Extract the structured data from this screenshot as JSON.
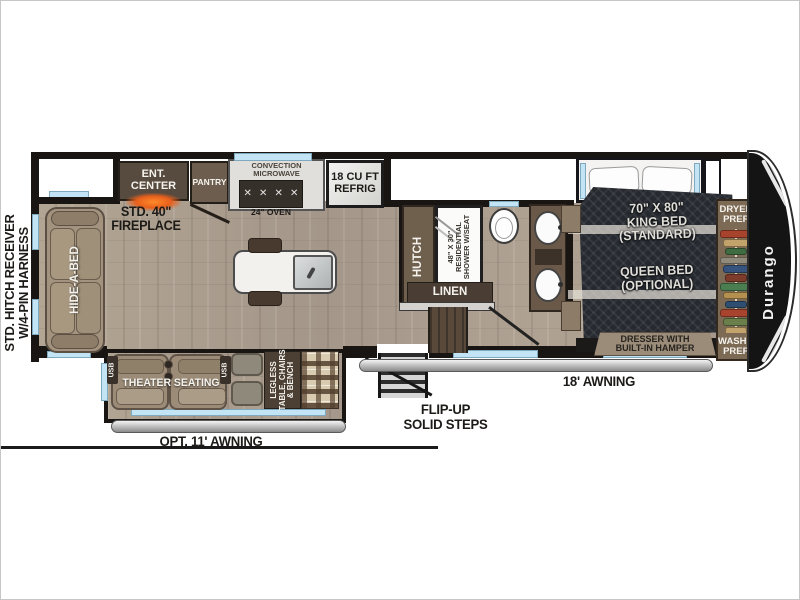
{
  "hitch": {
    "line1": "STD. HITCH RECEIVER",
    "line2": "W/4-PIN HARNESS"
  },
  "kitchen": {
    "ent_center": [
      "ENT.",
      "CENTER"
    ],
    "fireplace": [
      "STD. 40\"",
      "FIREPLACE"
    ],
    "pantry": "PANTRY",
    "microwave": [
      "CONVECTION",
      "MICROWAVE"
    ],
    "oven": "24\" OVEN",
    "refrig": [
      "18 CU FT",
      "REFRIG"
    ]
  },
  "living": {
    "hide_a_bed": "HIDE-A-BED",
    "theater": "THEATER SEATING",
    "usb_left": "USB",
    "usb_right": "USB",
    "dinette": [
      "LEGLESS",
      "TABLE, CHAIRS",
      "& BENCH"
    ],
    "hutch": "HUTCH"
  },
  "bath": {
    "shower": [
      "48\" X 30\"",
      "RESIDENTIAL",
      "SHOWER W/SEAT"
    ],
    "linen": "LINEN"
  },
  "bedroom": {
    "bed": [
      "70\" X 80\"",
      "KING BED",
      "(STANDARD)",
      "QUEEN BED",
      "(OPTIONAL)"
    ],
    "dresser": [
      "DRESSER WITH",
      "BUILT-IN HAMPER"
    ],
    "dryer": [
      "DRYER",
      "PREP"
    ],
    "washer": [
      "WASHER",
      "PREP"
    ],
    "closet_colors": [
      "#a8432d",
      "#c2a36b",
      "#3f6b41",
      "#8f8a7c",
      "#35537c",
      "#7d3b2b",
      "#4a7d50",
      "#b3904f",
      "#2f4f72",
      "#a8432d",
      "#6b7f4a",
      "#c2a36b",
      "#35537c",
      "#7d3b2b"
    ]
  },
  "exterior": {
    "logo": "Durango",
    "awning_main": "18' AWNING",
    "awning_opt": "OPT. 11' AWNING",
    "steps": [
      "FLIP-UP",
      "SOLID STEPS"
    ]
  },
  "icons": {
    "burner": "✕"
  },
  "colors": {
    "wall": "#181512",
    "window": "#c2e4f4",
    "floor": "#ab9e8d",
    "fireplace_glow": "#ff8a2a"
  }
}
